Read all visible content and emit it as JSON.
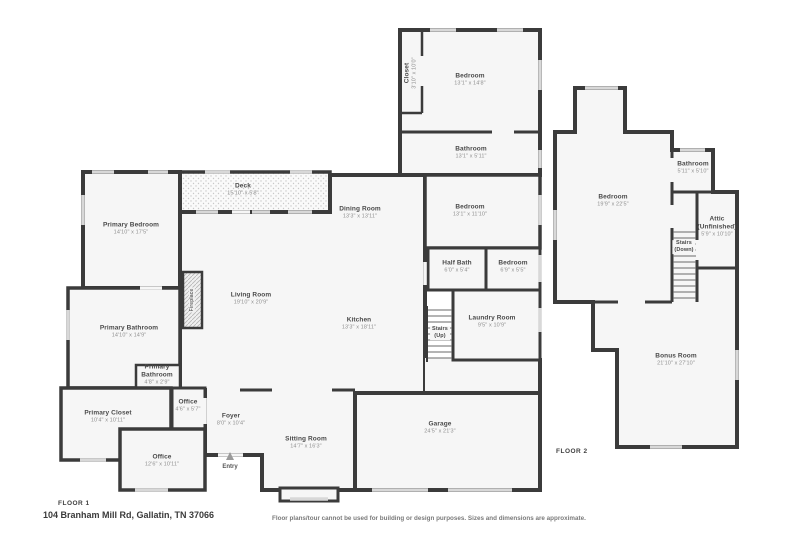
{
  "footer": {
    "address": "104 Branham Mill Rd, Gallatin, TN 37066",
    "disclaimer": "Floor plans/tour cannot be used for building or design purposes. Sizes and dimensions are approximate."
  },
  "colors": {
    "wall": "#3b3b3b",
    "room_fill": "#f6f6f6",
    "window": "#d8d8d8",
    "text": "#4a4a4a",
    "dims_text": "#8f8f8f"
  },
  "floor1": {
    "label": "FLOOR 1",
    "rooms": {
      "closet": {
        "name": "Closet",
        "dims": "3'10\" x 10'0\""
      },
      "bedroom_top": {
        "name": "Bedroom",
        "dims": "13'1\" x 14'8\""
      },
      "bathroom_top": {
        "name": "Bathroom",
        "dims": "13'1\" x 5'11\""
      },
      "bedroom_mid": {
        "name": "Bedroom",
        "dims": "13'1\" x 11'10\""
      },
      "half_bath": {
        "name": "Half Bath",
        "dims": "6'0\" x 5'4\""
      },
      "bedroom_small": {
        "name": "Bedroom",
        "dims": "6'9\" x 5'5\""
      },
      "laundry": {
        "name": "Laundry Room",
        "dims": "9'5\" x 10'9\""
      },
      "stairs_up": {
        "name": "Stairs",
        "sub": "(Up)"
      },
      "primary_bedroom": {
        "name": "Primary Bedroom",
        "dims": "14'10\" x 17'5\""
      },
      "deck": {
        "name": "Deck",
        "dims": "15'10\" x 5'8\""
      },
      "dining": {
        "name": "Dining Room",
        "dims": "13'3\" x 13'11\""
      },
      "living": {
        "name": "Living Room",
        "dims": "19'10\" x 20'9\""
      },
      "kitchen": {
        "name": "Kitchen",
        "dims": "13'3\" x 18'11\""
      },
      "fireplace": {
        "name": "Fireplace"
      },
      "primary_bathroom": {
        "name": "Primary Bathroom",
        "dims": "14'10\" x 14'9\""
      },
      "primary_bathroom_small": {
        "name": "Primary Bathroom",
        "dims": "4'8\" x 2'9\""
      },
      "primary_closet": {
        "name": "Primary Closet",
        "dims": "10'4\" x 10'11\""
      },
      "office_small": {
        "name": "Office",
        "dims": "4'6\" x 5'7\""
      },
      "office_large": {
        "name": "Office",
        "dims": "12'6\" x 10'11\""
      },
      "foyer": {
        "name": "Foyer",
        "dims": "8'0\" x 10'4\""
      },
      "sitting": {
        "name": "Sitting Room",
        "dims": "14'7\" x 16'3\""
      },
      "garage": {
        "name": "Garage",
        "dims": "24'5\" x 21'3\""
      },
      "entry": {
        "name": "Entry"
      }
    }
  },
  "floor2": {
    "label": "FLOOR 2",
    "rooms": {
      "bedroom": {
        "name": "Bedroom",
        "dims": "19'9\" x 22'5\""
      },
      "bathroom": {
        "name": "Bathroom",
        "dims": "5'11\" x 5'10\""
      },
      "attic": {
        "name": "Attic",
        "sub": "(Unfinished)",
        "dims": "5'9\" x 10'10\""
      },
      "stairs_down": {
        "name": "Stairs",
        "sub": "(Down)"
      },
      "bonus": {
        "name": "Bonus Room",
        "dims": "21'10\" x 27'10\""
      }
    }
  }
}
